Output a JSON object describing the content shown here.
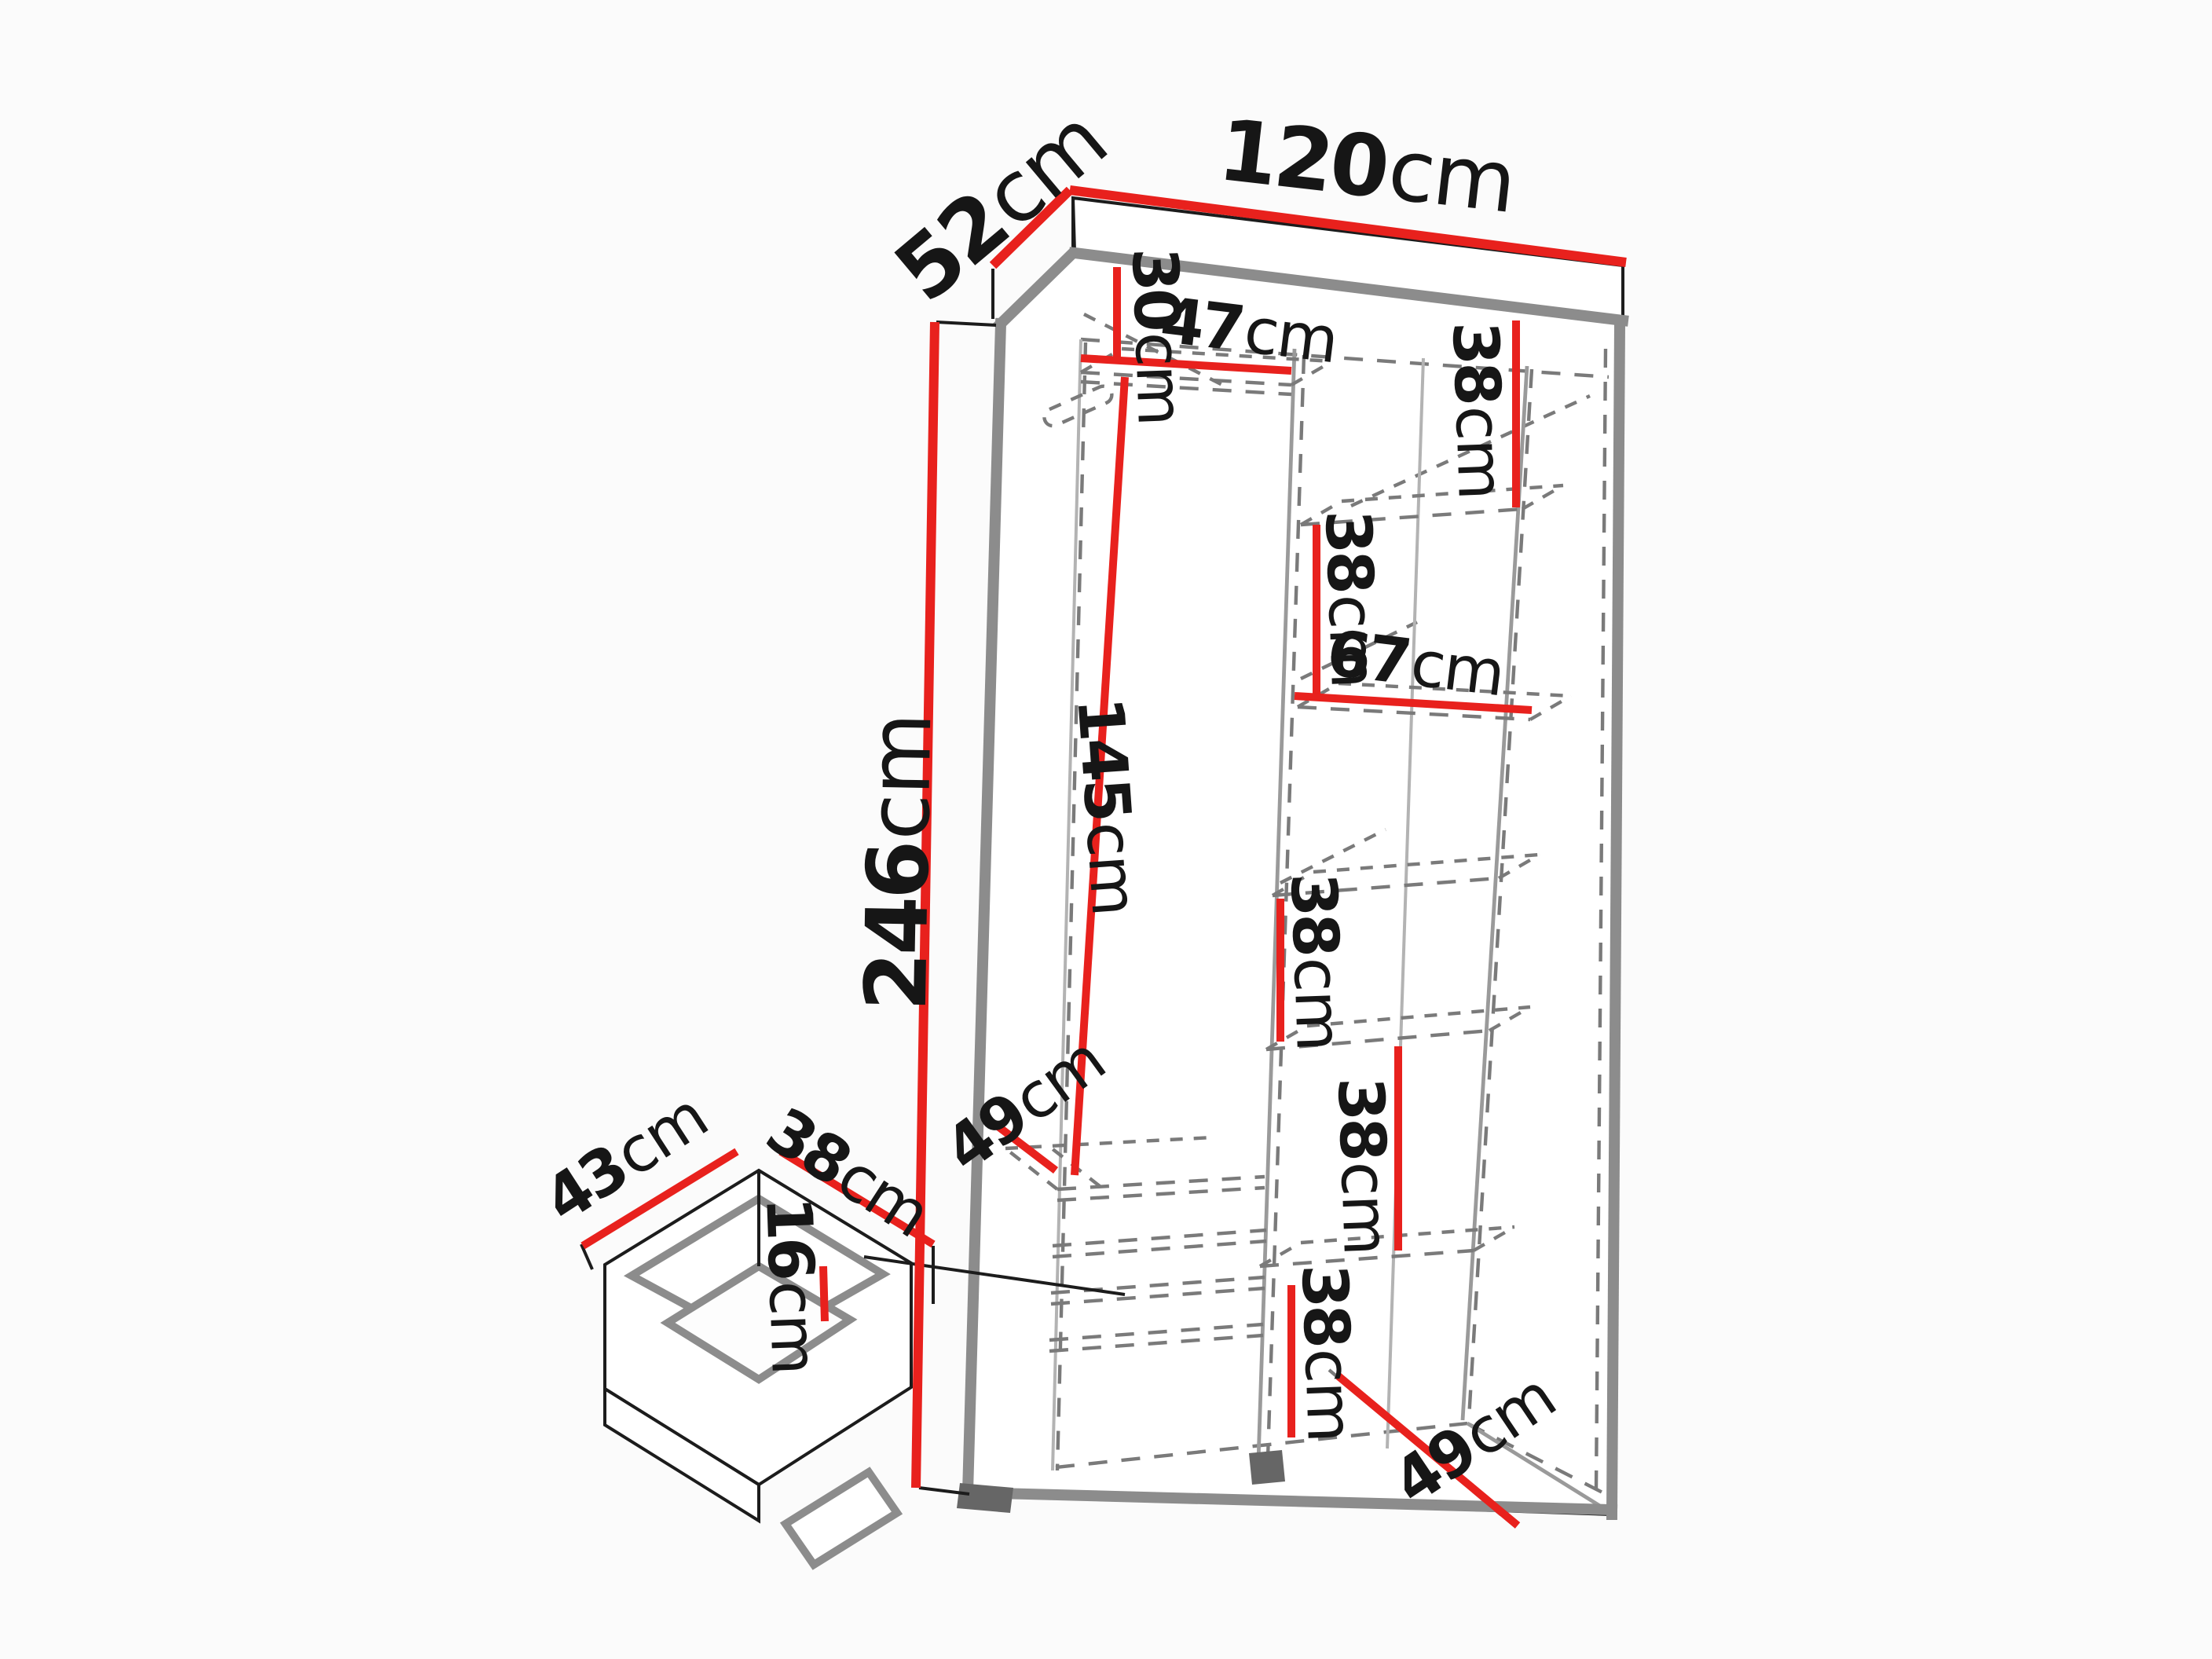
{
  "colors": {
    "dimension_red": "#e8211d",
    "edge_gray": "#8c8c8c",
    "dashed_gray": "#7a7a7a",
    "outline_black": "#1c1c1c",
    "label_text": "#161616",
    "background": "#fbfbfb"
  },
  "wardrobe": {
    "width": {
      "value": "120",
      "unit": "cm"
    },
    "depth": {
      "value": "52",
      "unit": "cm"
    },
    "height": {
      "value": "246",
      "unit": "cm"
    },
    "top_shelf_drop": {
      "value": "30",
      "unit": "cm"
    },
    "left_section_width": {
      "value": "47",
      "unit": "cm"
    },
    "right_section_width": {
      "value": "67",
      "unit": "cm"
    },
    "hanging_space_height": {
      "value": "145",
      "unit": "cm"
    },
    "shelf_gap_1": {
      "value": "38",
      "unit": "cm"
    },
    "shelf_gap_2": {
      "value": "38",
      "unit": "cm"
    },
    "shelf_gap_3": {
      "value": "38",
      "unit": "cm"
    },
    "shelf_gap_4": {
      "value": "38",
      "unit": "cm"
    },
    "bottom_section_height": {
      "value": "38",
      "unit": "cm"
    },
    "bottom_shelf_depth_left": {
      "value": "49",
      "unit": "cm"
    },
    "bottom_depth_right": {
      "value": "49",
      "unit": "cm"
    }
  },
  "drawer": {
    "width": {
      "value": "43",
      "unit": "cm"
    },
    "depth": {
      "value": "38",
      "unit": "cm"
    },
    "height": {
      "value": "16",
      "unit": "cm"
    }
  }
}
